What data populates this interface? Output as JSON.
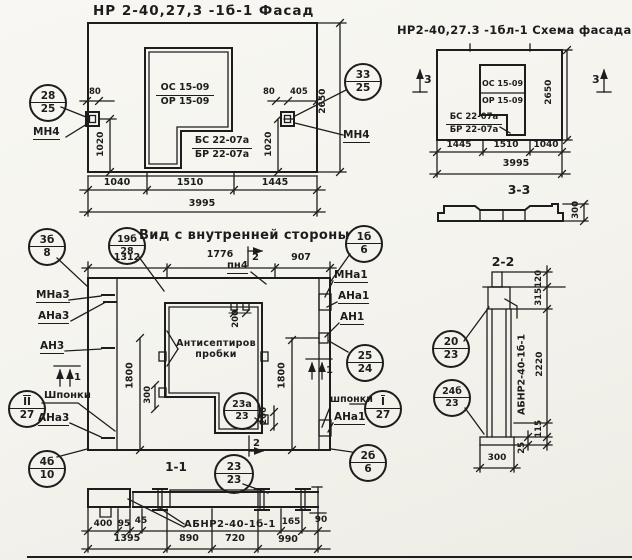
{
  "facade": {
    "title": "НР 2-40,27,3 -1б-1 Фасад",
    "win_top": "ОС 15-09",
    "win_bot": "ОР 15-09",
    "blk_top": "БС 22-07а",
    "blk_bot": "БР 22-07а",
    "mn4_left": "МН4",
    "mn4_right": "МН4",
    "callout_left": {
      "num": "28",
      "den": "25"
    },
    "callout_right": {
      "num": "33",
      "den": "25"
    },
    "dim_80_left": "80",
    "dim_80_right": "80",
    "dim_405": "405",
    "dim_1020_left": "1020",
    "dim_1020_right": "1020",
    "dim_height": "2650",
    "dim_b1": "1040",
    "dim_b2": "1510",
    "dim_b3": "1445",
    "dim_total": "3995"
  },
  "schema": {
    "title": "НР2-40,27.3 -1бл-1 Схема фасада",
    "win_top": "ОС 15-09",
    "win_bot": "ОР 15-09",
    "blk_top": "БС 22-07а",
    "blk_bot": "БР 22-07а",
    "marker_left": "3",
    "marker_right": "3",
    "dim_height": "2650",
    "dim_b1": "1445",
    "dim_b2": "1510",
    "dim_b3": "1040",
    "dim_total": "3995",
    "section_title": "3-3",
    "dim_thickness": "300"
  },
  "inner": {
    "title": "Вид с внутренней стороны",
    "callout_tl": {
      "num": "3б",
      "den": "8"
    },
    "callout_tl2": {
      "num": "19б",
      "den": "28"
    },
    "callout_tr": {
      "num": "1б",
      "den": "6"
    },
    "callout_right_mid": {
      "num": "25",
      "den": "24"
    },
    "callout_right_key": {
      "num": "I",
      "den": "27"
    },
    "callout_left_key": {
      "num": "II",
      "den": "27"
    },
    "callout_bl": {
      "num": "4б",
      "den": "10"
    },
    "callout_br": {
      "num": "2б",
      "den": "6"
    },
    "callout_window": {
      "num": "23а",
      "den": "23"
    },
    "dim_t1": "1312",
    "dim_t2": "1776",
    "dim_t3": "907",
    "marker_top": "2",
    "marker_bottom": "2",
    "marker_left": "1",
    "marker_right": "1",
    "label_pn4": "пн4",
    "label_mna3": "МНа3",
    "label_ana3_top": "АНа3",
    "label_an3": "АН3",
    "label_keys_left": "Шпонки",
    "label_ana3_bot": "АНа3",
    "label_mna1": "МНа1",
    "label_ana1_top": "АНа1",
    "label_an1": "АН1",
    "label_keys_right": "шпонки",
    "label_ana1_bot": "АНа1",
    "note_line1": "Антисептиров",
    "note_line2": "пробки",
    "dim_1800_left": "1800",
    "dim_300_left": "300",
    "dim_1800_right": "1800",
    "dim_200_top": "200",
    "dim_200_win": "200"
  },
  "sec11": {
    "title": "1-1",
    "callout": {
      "num": "23",
      "den": "23"
    },
    "label": "АБНР2-40-1б-1",
    "d400": "400",
    "d95": "95",
    "d45": "45",
    "d165": "165",
    "d90": "90",
    "d1395": "1395",
    "d890": "890",
    "d720": "720",
    "d990": "990"
  },
  "sec22": {
    "title": "2-2",
    "callout_top": {
      "num": "20",
      "den": "23"
    },
    "callout_bot": {
      "num": "24б",
      "den": "23"
    },
    "label": "АБНР2-40-1б-1",
    "d120": "120",
    "d315": "315",
    "d2220": "2220",
    "d115": "115",
    "d25": "25",
    "d300": "300"
  }
}
